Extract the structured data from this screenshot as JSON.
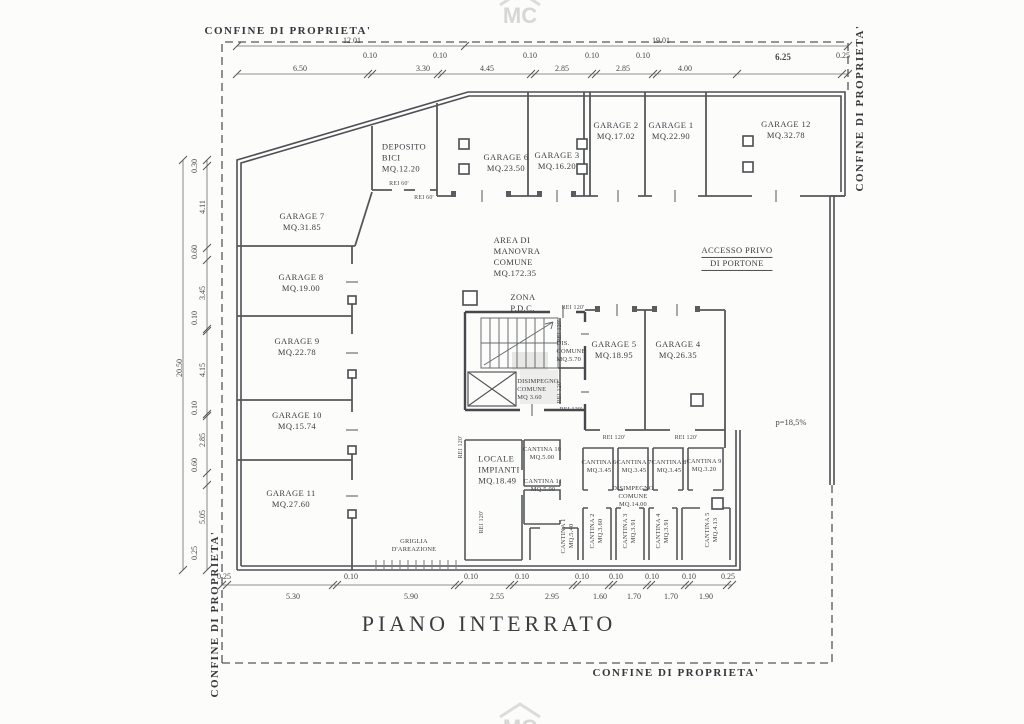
{
  "title": "PIANO INTERRATO",
  "watermark": {
    "text": "MC"
  },
  "boundary": {
    "label": "CONFINE DI PROPRIETA'"
  },
  "ramp": {
    "slope": "p=18,5%"
  },
  "fire": {
    "rei60": "REI 60'",
    "rei120": "REI 120'"
  },
  "rooms": {
    "garage_7": {
      "l1": "GARAGE 7",
      "l2": "MQ.31.85"
    },
    "garage_8": {
      "l1": "GARAGE 8",
      "l2": "MQ.19.00"
    },
    "garage_9": {
      "l1": "GARAGE 9",
      "l2": "MQ.22.78"
    },
    "garage_10": {
      "l1": "GARAGE 10",
      "l2": "MQ.15.74"
    },
    "garage_11": {
      "l1": "GARAGE 11",
      "l2": "MQ.27.60"
    },
    "deposito_bici": {
      "l1": "DEPOSITO",
      "l2": "BICI",
      "l3": "MQ.12.20"
    },
    "garage_6": {
      "l1": "GARAGE 6",
      "l2": "MQ.23.50"
    },
    "garage_3": {
      "l1": "GARAGE 3",
      "l2": "MQ.16.20"
    },
    "garage_2": {
      "l1": "GARAGE 2",
      "l2": "MQ.17.02"
    },
    "garage_1": {
      "l1": "GARAGE 1",
      "l2": "MQ.22.90"
    },
    "garage_12": {
      "l1": "GARAGE 12",
      "l2": "MQ.32.78"
    },
    "area_manovra": {
      "l1": "AREA DI",
      "l2": "MANOVRA",
      "l3": "COMUNE",
      "l4": "MQ.172.35"
    },
    "zona_pdc": {
      "l1": "ZONA",
      "l2": "P.D.C."
    },
    "accesso": {
      "l1": "ACCESSO PRIVO",
      "l2": "DI PORTONE"
    },
    "garage_5": {
      "l1": "GARAGE 5",
      "l2": "MQ.18.95"
    },
    "garage_4": {
      "l1": "GARAGE 4",
      "l2": "MQ.26.35"
    },
    "dis_comune": {
      "l1": "DIS.",
      "l2": "COMUNE",
      "l3": "MQ.5.70"
    },
    "disimpegno_comune": {
      "l1": "DISIMPEGNO",
      "l2": "COMUNE",
      "l3": "MQ 3.60"
    },
    "locale_impianti": {
      "l1": "LOCALE",
      "l2": "IMPIANTI",
      "l3": "MQ.18.49"
    },
    "cantina_10": {
      "l1": "CANTINA 10",
      "l2": "MQ.5.00"
    },
    "cantina_11": {
      "l1": "CANTINA 11",
      "l2": "MQ.5.00"
    },
    "cantina_6": {
      "l1": "CANTINA 6",
      "l2": "MQ.3.45"
    },
    "cantina_7": {
      "l1": "CANTINA 7",
      "l2": "MQ.3.45"
    },
    "cantina_8": {
      "l1": "CANTINA 8",
      "l2": "MQ.3.45"
    },
    "cantina_9": {
      "l1": "CANTINA 9",
      "l2": "MQ.3.20"
    },
    "disimpegno_grande": {
      "l1": "DISIMPEGNO",
      "l2": "COMUNE",
      "l3": "MQ.14.00"
    },
    "cantina_1": {
      "l1": "CANTINA 1",
      "l2": "MQ.5.40"
    },
    "cantina_2": {
      "l1": "CANTINA 2",
      "l2": "MQ.3.60"
    },
    "cantina_3": {
      "l1": "CANTINA 3",
      "l2": "MQ.3.91"
    },
    "cantina_4": {
      "l1": "CANTINA 4",
      "l2": "MQ.3.91"
    },
    "cantina_5": {
      "l1": "CANTINA 5",
      "l2": "MQ.4.13"
    },
    "griglia": {
      "l1": "GRIGLIA",
      "l2": "D'AREAZIONE"
    }
  },
  "dims": {
    "top_overall": [
      "12.01",
      "19.01"
    ],
    "top_row": [
      "6.50",
      "0.10",
      "3.30",
      "0.10",
      "4.45",
      "0.10",
      "2.85",
      "0.10",
      "2.85",
      "0.10",
      "4.00",
      "6.25",
      "0.25"
    ],
    "left_overall": "20.50",
    "left_col": [
      "0.30",
      "4.11",
      "0.60",
      "3.45",
      "0.10",
      "4.15",
      "0.10",
      "2.85",
      "0.60",
      "5.05",
      "0.25"
    ],
    "bottom_row": [
      "0.25",
      "5.30",
      "0.10",
      "5.90",
      "0.10",
      "2.55",
      "0.10",
      "2.95",
      "0.10",
      "1.60",
      "0.10",
      "1.70",
      "0.10",
      "1.70",
      "0.10",
      "1.90",
      "0.25"
    ]
  }
}
